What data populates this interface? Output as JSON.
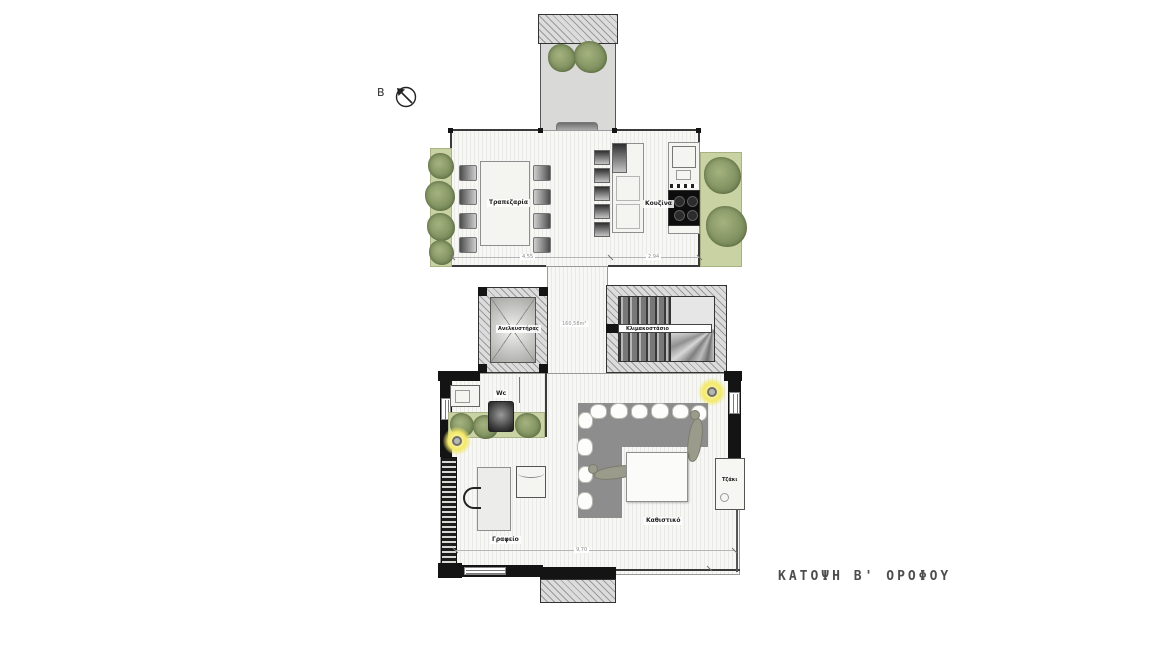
{
  "drawing": {
    "title": "ΚΑΤΟΨΗ Β' ΟΡΟΦΟΥ",
    "north_label": "B",
    "total_area": "160,58m²"
  },
  "labels": {
    "dining": "Τραπεζαρία",
    "kitchen": "Κουζίνα",
    "elevator": "Ανελκυστήρας",
    "staircase": "Κλιμακοστάσιο",
    "wc": "Wc",
    "office": "Γραφείο",
    "living_room": "Καθιστικό",
    "fireplace": "Τζάκι"
  },
  "dimensions": {
    "upper_width_left": "4,55",
    "upper_width_right": "2,94",
    "lower_width": "9,70"
  },
  "colors": {
    "wall": "#141414",
    "planting_strip": "#c9d2a3",
    "tree": "#7f905f",
    "sofa": "#8d8d8d",
    "light_glow": "#f3e96a",
    "title_text": "#4d4d4d"
  }
}
